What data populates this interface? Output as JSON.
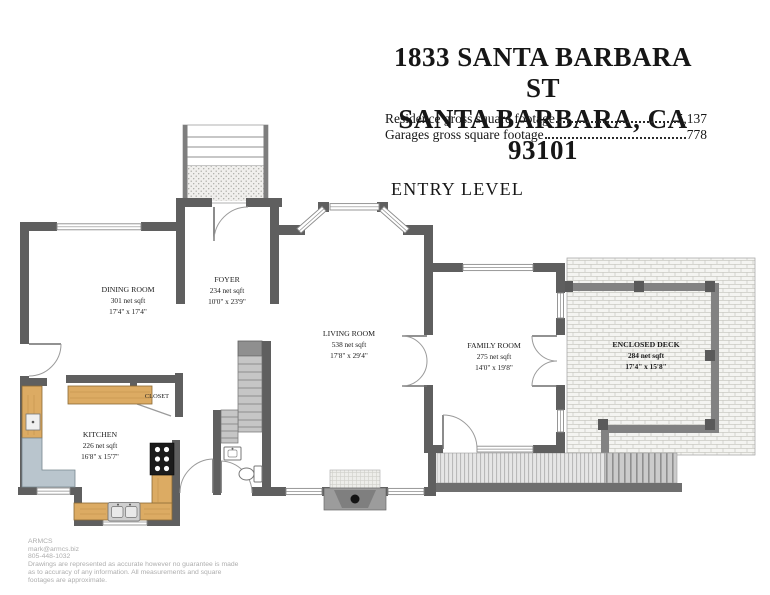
{
  "header": {
    "title_line1": "1833 SANTA BARBARA ST",
    "title_line2": "SANTA BARBARA, CA 93101",
    "footage": [
      {
        "label": "Residence gross square footage",
        "value": "5,137"
      },
      {
        "label": "Garages gross square footage",
        "value": "778"
      }
    ],
    "level_title": "ENTRY LEVEL"
  },
  "rooms": {
    "dining": {
      "name": "DINING ROOM",
      "area": "301 net sqft",
      "dims": "17'4\" x 17'4\""
    },
    "foyer": {
      "name": "FOYER",
      "area": "234 net sqft",
      "dims": "10'0\" x 23'9\""
    },
    "living": {
      "name": "LIVING ROOM",
      "area": "538 net sqft",
      "dims": "17'8\" x 29'4\""
    },
    "family": {
      "name": "FAMILY ROOM",
      "area": "275 net sqft",
      "dims": "14'0\" x 19'8\""
    },
    "deck": {
      "name": "ENCLOSED DECK",
      "area": "284 net sqft",
      "dims": "17'4\" x 15'8\""
    },
    "kitchen": {
      "name": "KITCHEN",
      "area": "226 net sqft",
      "dims": "16'8\" x 15'7\""
    },
    "closet": {
      "name": "CLOSET"
    }
  },
  "footer": {
    "company": "ARMCS",
    "email": "mark@armcs.biz",
    "phone": "805-448-1032",
    "disclaimer_line1": "Drawings are represented as accurate however no guarantee is made",
    "disclaimer_line2": "as to accuracy of any information. All measurements and square",
    "disclaimer_line3": "footages are approximate."
  },
  "colors": {
    "wall": "#5f5f5f",
    "deck_wall": "#828282",
    "counter_wood": "#dcab63",
    "counter_gray": "#b9c5cd",
    "stair_fill": "#c6c6c6",
    "text": "#161616"
  }
}
